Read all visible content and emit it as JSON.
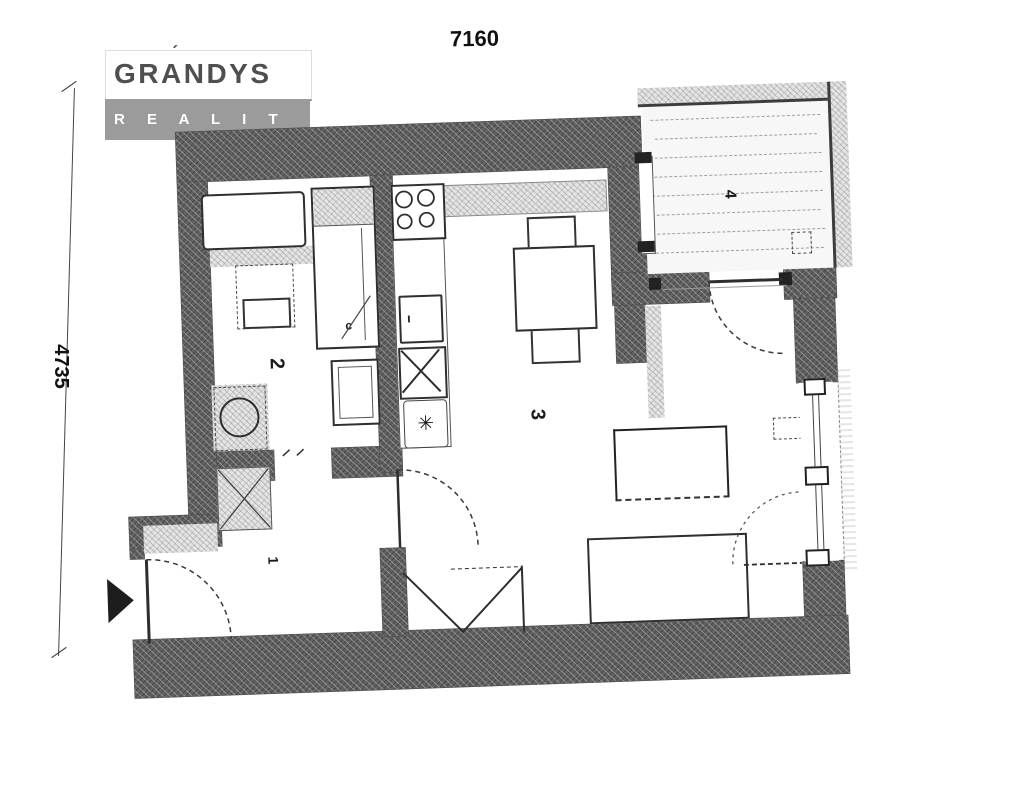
{
  "logo": {
    "brand_top": "GRANDYS",
    "brand_accent": "ˊ",
    "brand_bottom": "R E A L I T Y"
  },
  "dimensions": {
    "top": "7160",
    "left": "4735"
  },
  "rooms": {
    "hallway": {
      "label": "1"
    },
    "bathroom": {
      "label": "2"
    },
    "living_kitchen": {
      "label": "3"
    },
    "balcony": {
      "label": "4"
    }
  },
  "marks": {
    "oven": "ι",
    "tall_cabinet": "c",
    "sink_unit": "✳"
  },
  "colors": {
    "wall": "#616161",
    "light_hatch": "#e4e4e4",
    "logo_gray": "#9b9b9b",
    "logo_text": "#4f4f4f",
    "line": "#2e2e2e"
  }
}
